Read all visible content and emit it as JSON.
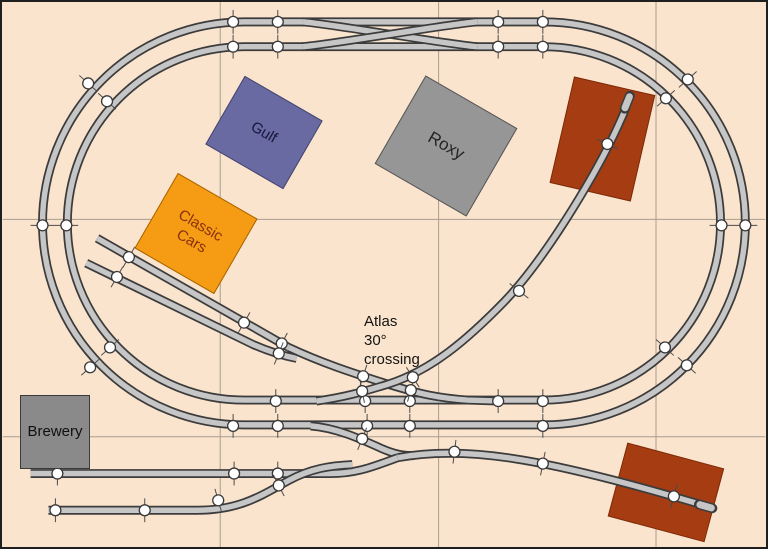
{
  "canvas": {
    "width": 768,
    "height": 549,
    "background": "#fbe4cd",
    "border_color": "#1f1f1f"
  },
  "grid": {
    "color": "#a79d90",
    "x_lines": [
      219,
      439,
      658
    ],
    "y_lines": [
      219,
      438
    ]
  },
  "annotation": {
    "text": "Atlas\n30°\ncrossing",
    "x": 362,
    "y": 311,
    "font_size": 15,
    "color": "#141414"
  },
  "track_style": {
    "edge_color": "#3c3c3c",
    "fill_color": "#c6c6c6",
    "edge_width": 9,
    "fill_width": 5.5,
    "joint_fill": "#ffffff",
    "joint_stroke": "#383838",
    "joint_radius": 5.5,
    "tick_color": "#4a4a4a",
    "tick_length": 24
  },
  "tracks": [
    {
      "name": "outer-loop",
      "layer": 1,
      "d": "M 243 20 H 545 A 203 203 0 0 1 748 223 A 203 203 0 0 1 545 426 H 243 A 203 203 0 0 1 40 223 A 203 203 0 0 1 243 20"
    },
    {
      "name": "inner-loop",
      "layer": 1,
      "d": "M 243 45 H 545 A 178 178 0 0 1 723 223 A 178 178 0 0 1 545 401 H 243 A 178 178 0 0 1 65 223 A 178 178 0 0 1 243 45"
    },
    {
      "name": "crossover-diagonal-1",
      "layer": 1,
      "d": "M 302 20 C 330 22 450 43 478 45"
    },
    {
      "name": "crossover-diagonal-2",
      "layer": 1,
      "d": "M 302 45 C 330 43 450 22 478 20"
    },
    {
      "name": "siding-stub-upper",
      "layer": 1,
      "d": "M 95 238 L 288 348"
    },
    {
      "name": "siding-stub-lower",
      "layer": 1,
      "d": "M 84 263 L 252 345 C 268 352 280 356 296 359"
    },
    {
      "name": "siding-lead-through-crossing",
      "layer": 1,
      "d": "M 288 348 C 320 363 350 373 388 385 C 420 395 440 399 468 401 L 500 402"
    },
    {
      "name": "yard-branch-from-outer",
      "layer": 1,
      "d": "M 310 427 C 336 429 360 440 382 450 C 396 456 404 457 414 457"
    },
    {
      "name": "yard-track-1",
      "layer": 1,
      "d": "M 28 475 H 330 C 358 475 375 467 398 459"
    },
    {
      "name": "yard-track-2",
      "layer": 1,
      "d": "M 46 512 H 196 C 240 512 262 496 288 482 C 310 470 330 467 352 466"
    },
    {
      "name": "spur-to-upper-shed",
      "layer": 2,
      "d": "M 316 402 C 344 398 362 393 388 385 C 432 371 468 340 505 302 C 548 257 605 163 628 106"
    },
    {
      "name": "spur-to-lower-shed",
      "layer": 2,
      "d": "M 398 459 C 430 453 470 453 515 460 C 575 469 655 492 706 507"
    }
  ],
  "bumpers": [
    {
      "x": 629,
      "y": 101,
      "a": -68
    },
    {
      "x": 708,
      "y": 508,
      "a": 16
    }
  ],
  "joints": [
    [
      232,
      20,
      0
    ],
    [
      277,
      20,
      0
    ],
    [
      499,
      20,
      0
    ],
    [
      544,
      20,
      0
    ],
    [
      232,
      45,
      0
    ],
    [
      277,
      45,
      0
    ],
    [
      499,
      45,
      0
    ],
    [
      544,
      45,
      0
    ],
    [
      86,
      82,
      -48
    ],
    [
      105,
      100,
      -48
    ],
    [
      40,
      225,
      90
    ],
    [
      64,
      225,
      90
    ],
    [
      88,
      368,
      48
    ],
    [
      108,
      348,
      48
    ],
    [
      690,
      78,
      48
    ],
    [
      668,
      97,
      48
    ],
    [
      748,
      225,
      90
    ],
    [
      724,
      225,
      90
    ],
    [
      689,
      366,
      -48
    ],
    [
      667,
      348,
      -48
    ],
    [
      275,
      402,
      0
    ],
    [
      365,
      402,
      0
    ],
    [
      410,
      402,
      0
    ],
    [
      499,
      402,
      0
    ],
    [
      544,
      402,
      0
    ],
    [
      232,
      427,
      0
    ],
    [
      277,
      427,
      0
    ],
    [
      367,
      427,
      0
    ],
    [
      410,
      427,
      0
    ],
    [
      544,
      427,
      0
    ],
    [
      127,
      257,
      30
    ],
    [
      243,
      323,
      30
    ],
    [
      281,
      344,
      28
    ],
    [
      115,
      277,
      30
    ],
    [
      278,
      354,
      22
    ],
    [
      363,
      377,
      18
    ],
    [
      411,
      391,
      16
    ],
    [
      362,
      392,
      -11
    ],
    [
      413,
      378,
      -33
    ],
    [
      520,
      291,
      -52
    ],
    [
      609,
      143,
      -65
    ],
    [
      362,
      440,
      22
    ],
    [
      55,
      475,
      0
    ],
    [
      233,
      475,
      0
    ],
    [
      277,
      475,
      0
    ],
    [
      53,
      512,
      0
    ],
    [
      143,
      512,
      0
    ],
    [
      217,
      502,
      -16
    ],
    [
      278,
      487,
      -27
    ],
    [
      455,
      453,
      7
    ],
    [
      544,
      465,
      11
    ],
    [
      676,
      498,
      16
    ]
  ],
  "sheds": [
    {
      "name": "shed-upper",
      "cx": 604,
      "cy": 138,
      "w": 83,
      "h": 109,
      "rot": 13,
      "fill": "#a63c11",
      "stroke": "#7c2a08"
    },
    {
      "name": "shed-lower",
      "cx": 668,
      "cy": 494,
      "w": 100,
      "h": 76,
      "rot": 15,
      "fill": "#a63c11",
      "stroke": "#7c2a08"
    }
  ],
  "buildings": [
    {
      "id": "gulf",
      "label": "Gulf",
      "cx": 262,
      "cy": 130,
      "w": 90,
      "h": 79,
      "rot": 30,
      "fill": "#6a6aa2",
      "border": "#45456e",
      "text_color": "#16163c",
      "font_size": 15
    },
    {
      "id": "classic",
      "label": "Classic\nCars",
      "cx": 194,
      "cy": 231,
      "w": 92,
      "h": 87,
      "rot": 30,
      "fill": "#f69c14",
      "border": "#a66400",
      "text_color": "#8a3110",
      "font_size": 15
    },
    {
      "id": "roxy",
      "label": "Roxy",
      "cx": 444,
      "cy": 144,
      "w": 106,
      "h": 102,
      "rot": 30,
      "fill": "#969696",
      "border": "#565656",
      "text_color": "#242424",
      "font_size": 17
    },
    {
      "id": "brewery",
      "label": "Brewery",
      "cx": 53,
      "cy": 430,
      "w": 70,
      "h": 74,
      "rot": 0,
      "fill": "#8a8a8a",
      "border": "#3a3a3a",
      "text_color": "#101010",
      "font_size": 15
    }
  ]
}
